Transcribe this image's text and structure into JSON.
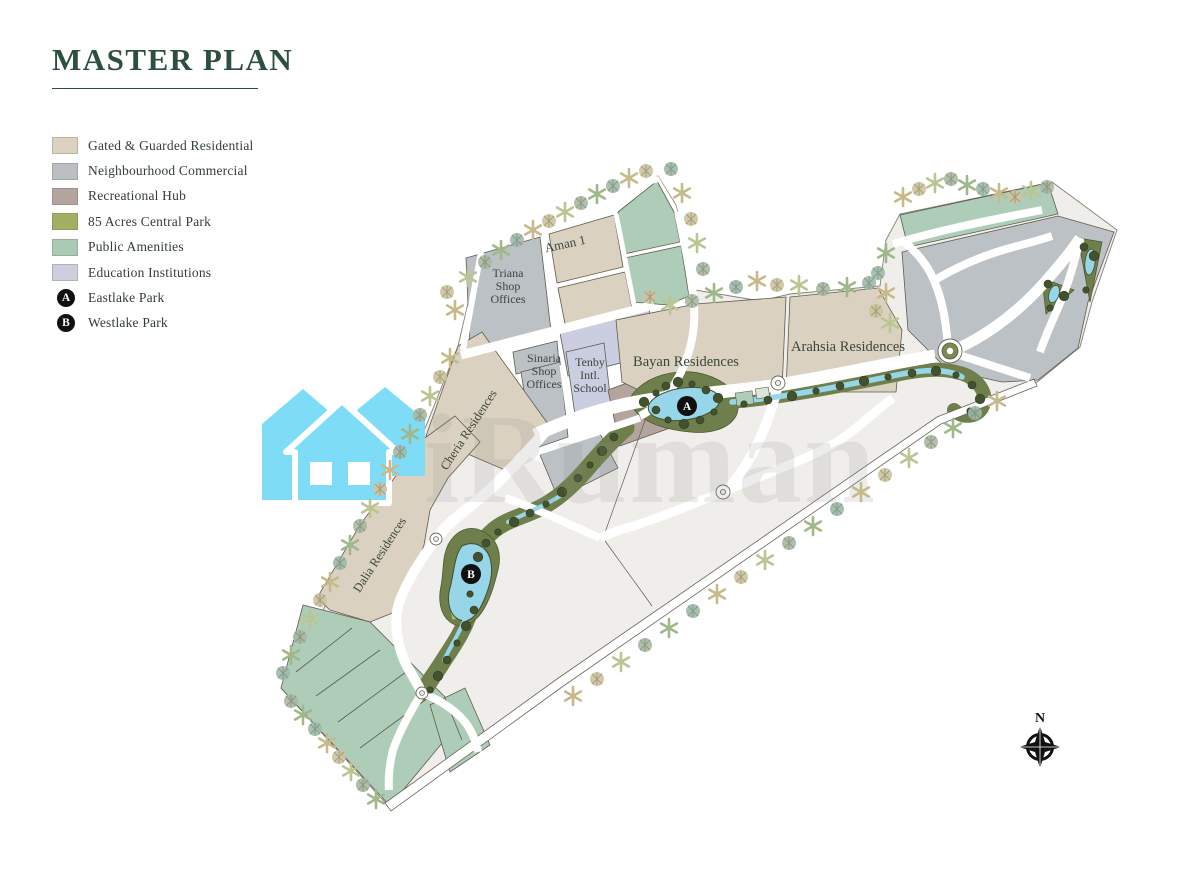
{
  "page": {
    "title": "MASTER PLAN"
  },
  "legend": {
    "items": [
      {
        "label": "Gated & Guarded Residential",
        "type": "swatch",
        "color": "#ddd2bf"
      },
      {
        "label": "Neighbourhood Commercial",
        "type": "swatch",
        "color": "#b9bfc3"
      },
      {
        "label": "Recreational Hub",
        "type": "swatch",
        "color": "#b3a49e"
      },
      {
        "label": "85 Acres Central Park",
        "type": "swatch",
        "color": "#a3b064"
      },
      {
        "label": "Public Amenities",
        "type": "swatch",
        "color": "#abcab6"
      },
      {
        "label": "Education Institutions",
        "type": "swatch",
        "color": "#cdcfdf"
      },
      {
        "label": "Eastlake Park",
        "type": "marker",
        "marker": "A"
      },
      {
        "label": "Westlake Park",
        "type": "marker",
        "marker": "B"
      }
    ]
  },
  "map": {
    "labels": [
      {
        "name": "aman-1",
        "lines": [
          "Aman 1"
        ],
        "x": 566,
        "y": 248,
        "size": 13,
        "rotate": -12
      },
      {
        "name": "triana-shop-offices",
        "lines": [
          "Triana",
          "Shop",
          "Offices"
        ],
        "x": 508,
        "y": 277,
        "size": 12,
        "rotate": 0
      },
      {
        "name": "sinaria-shop-offices",
        "lines": [
          "Sinaria",
          "Shop",
          "Offices"
        ],
        "x": 544,
        "y": 362,
        "size": 12,
        "rotate": 0
      },
      {
        "name": "tenby-intl-school",
        "lines": [
          "Tenby",
          "Intl.",
          "School"
        ],
        "x": 590,
        "y": 366,
        "size": 12,
        "rotate": 0
      },
      {
        "name": "bayan-residences",
        "lines": [
          "Bayan Residences"
        ],
        "x": 686,
        "y": 366,
        "size": 14.5,
        "rotate": 0
      },
      {
        "name": "arahsia-residences",
        "lines": [
          "Arahsia Residences"
        ],
        "x": 848,
        "y": 351,
        "size": 14.5,
        "rotate": 0
      },
      {
        "name": "cheria-residences",
        "lines": [
          "Cheria Residences"
        ],
        "x": 472,
        "y": 432,
        "size": 12.5,
        "rotate": -57
      },
      {
        "name": "dalia-residences",
        "lines": [
          "Dalia Residences"
        ],
        "x": 383,
        "y": 557,
        "size": 12.5,
        "rotate": -57
      }
    ],
    "markers": [
      {
        "letter": "A",
        "name": "eastlake-park-marker",
        "x": 687,
        "y": 406
      },
      {
        "letter": "B",
        "name": "westlake-park-marker",
        "x": 471,
        "y": 574
      }
    ]
  },
  "watermark": {
    "text": "iRuman",
    "house_color": "#7fdcf7"
  },
  "compass": {
    "label": "N"
  }
}
